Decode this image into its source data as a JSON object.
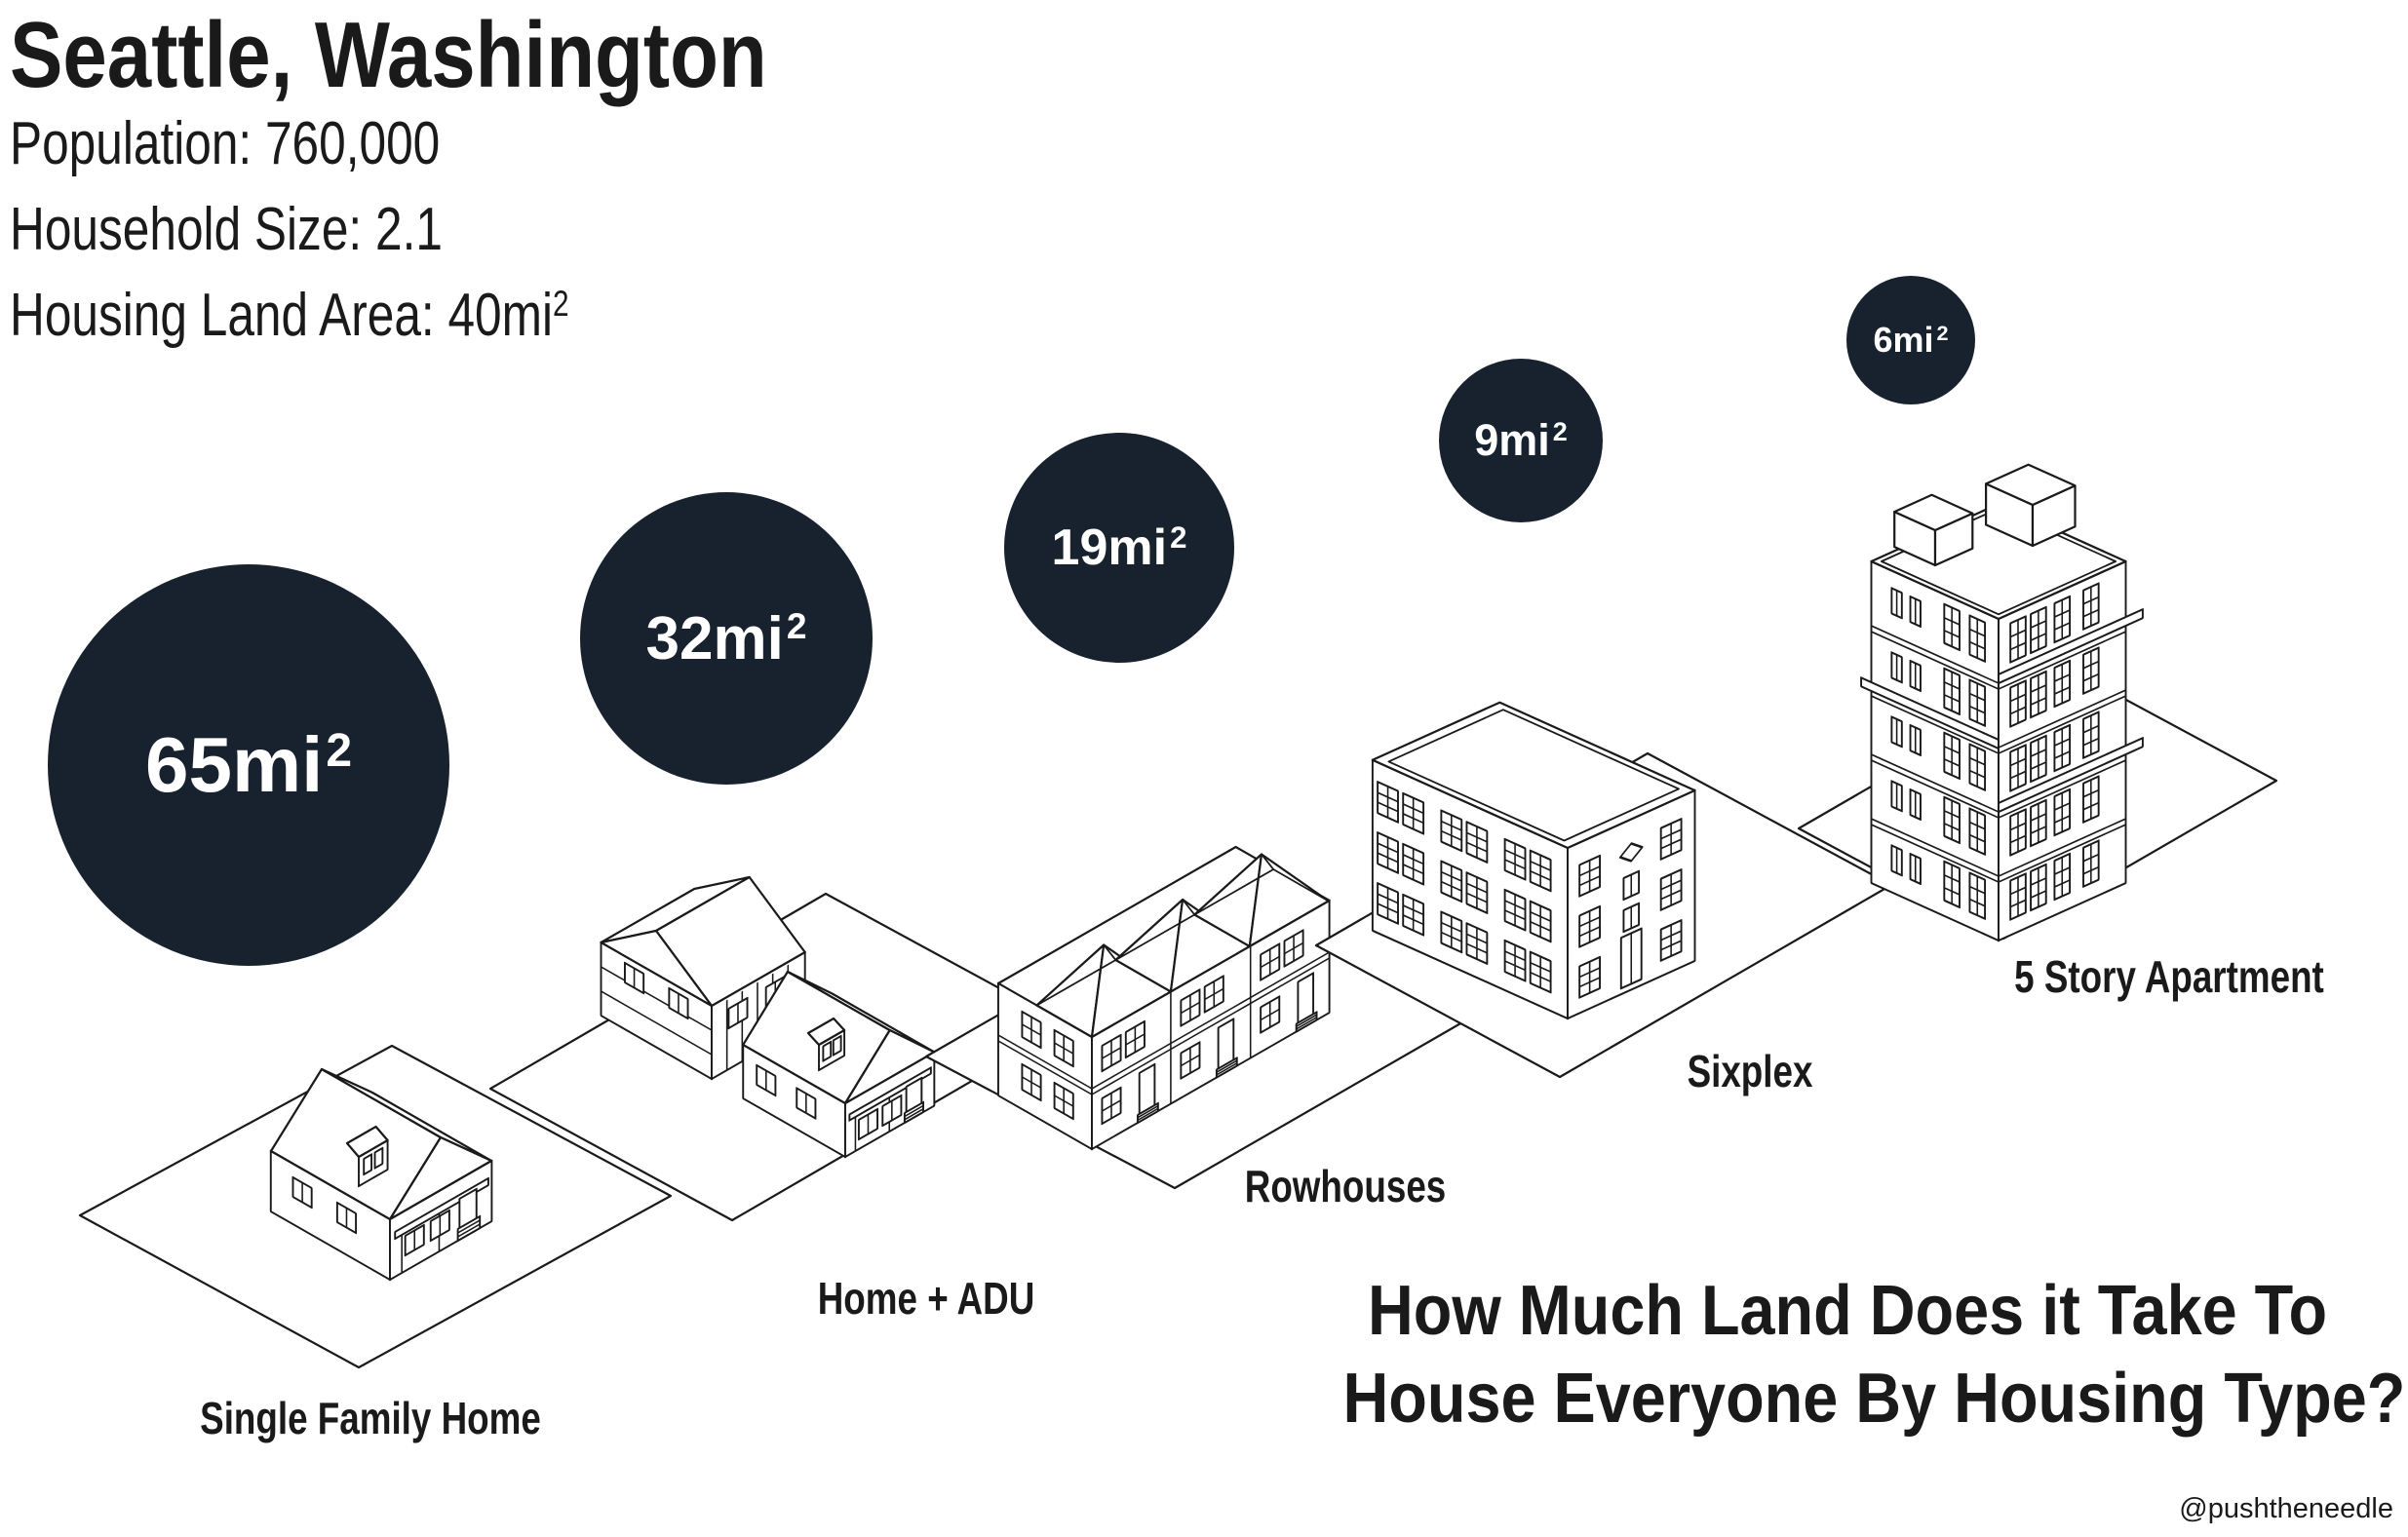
{
  "header": {
    "city": "Seattle, Washington",
    "population": "Population: 760,000",
    "household_size": "Household Size: 2.1",
    "land_area_prefix": "Housing Land Area: 40mi",
    "land_area_sup": "2"
  },
  "question": {
    "line1": "How Much Land Does it Take To",
    "line2": "House Everyone By Housing Type?"
  },
  "credit": "@pushtheneedle",
  "colors": {
    "bubble": "#17222E",
    "bubble_text": "#FFFFFF",
    "ink": "#1A1A1A",
    "background": "#FFFFFF"
  },
  "chart_data": {
    "type": "bubble",
    "title": "How Much Land Does it Take To House Everyone By Housing Type?",
    "subtitle": "Seattle, Washington",
    "context": {
      "city": "Seattle, Washington",
      "population": 760000,
      "household_size": 2.1,
      "housing_land_area_sq_mi": 40
    },
    "unit": "mi²",
    "categories": [
      "Single Family Home",
      "Home + ADU",
      "Rowhouses",
      "Sixplex",
      "5 Story Apartment"
    ],
    "values": [
      65,
      32,
      19,
      9,
      6
    ],
    "items": [
      {
        "label": "Single Family Home",
        "area_sq_mi": 65,
        "bubble_text": "65mi",
        "bubble_sup": "2",
        "illustration": "single-family-home"
      },
      {
        "label": "Home + ADU",
        "area_sq_mi": 32,
        "bubble_text": "32mi",
        "bubble_sup": "2",
        "illustration": "home-plus-adu"
      },
      {
        "label": "Rowhouses",
        "area_sq_mi": 19,
        "bubble_text": "19mi",
        "bubble_sup": "2",
        "illustration": "rowhouses"
      },
      {
        "label": "Sixplex",
        "area_sq_mi": 9,
        "bubble_text": "9mi",
        "bubble_sup": "2",
        "illustration": "sixplex"
      },
      {
        "label": "5 Story Apartment",
        "area_sq_mi": 6,
        "bubble_text": "6mi",
        "bubble_sup": "2",
        "illustration": "five-story-apartment"
      }
    ]
  }
}
